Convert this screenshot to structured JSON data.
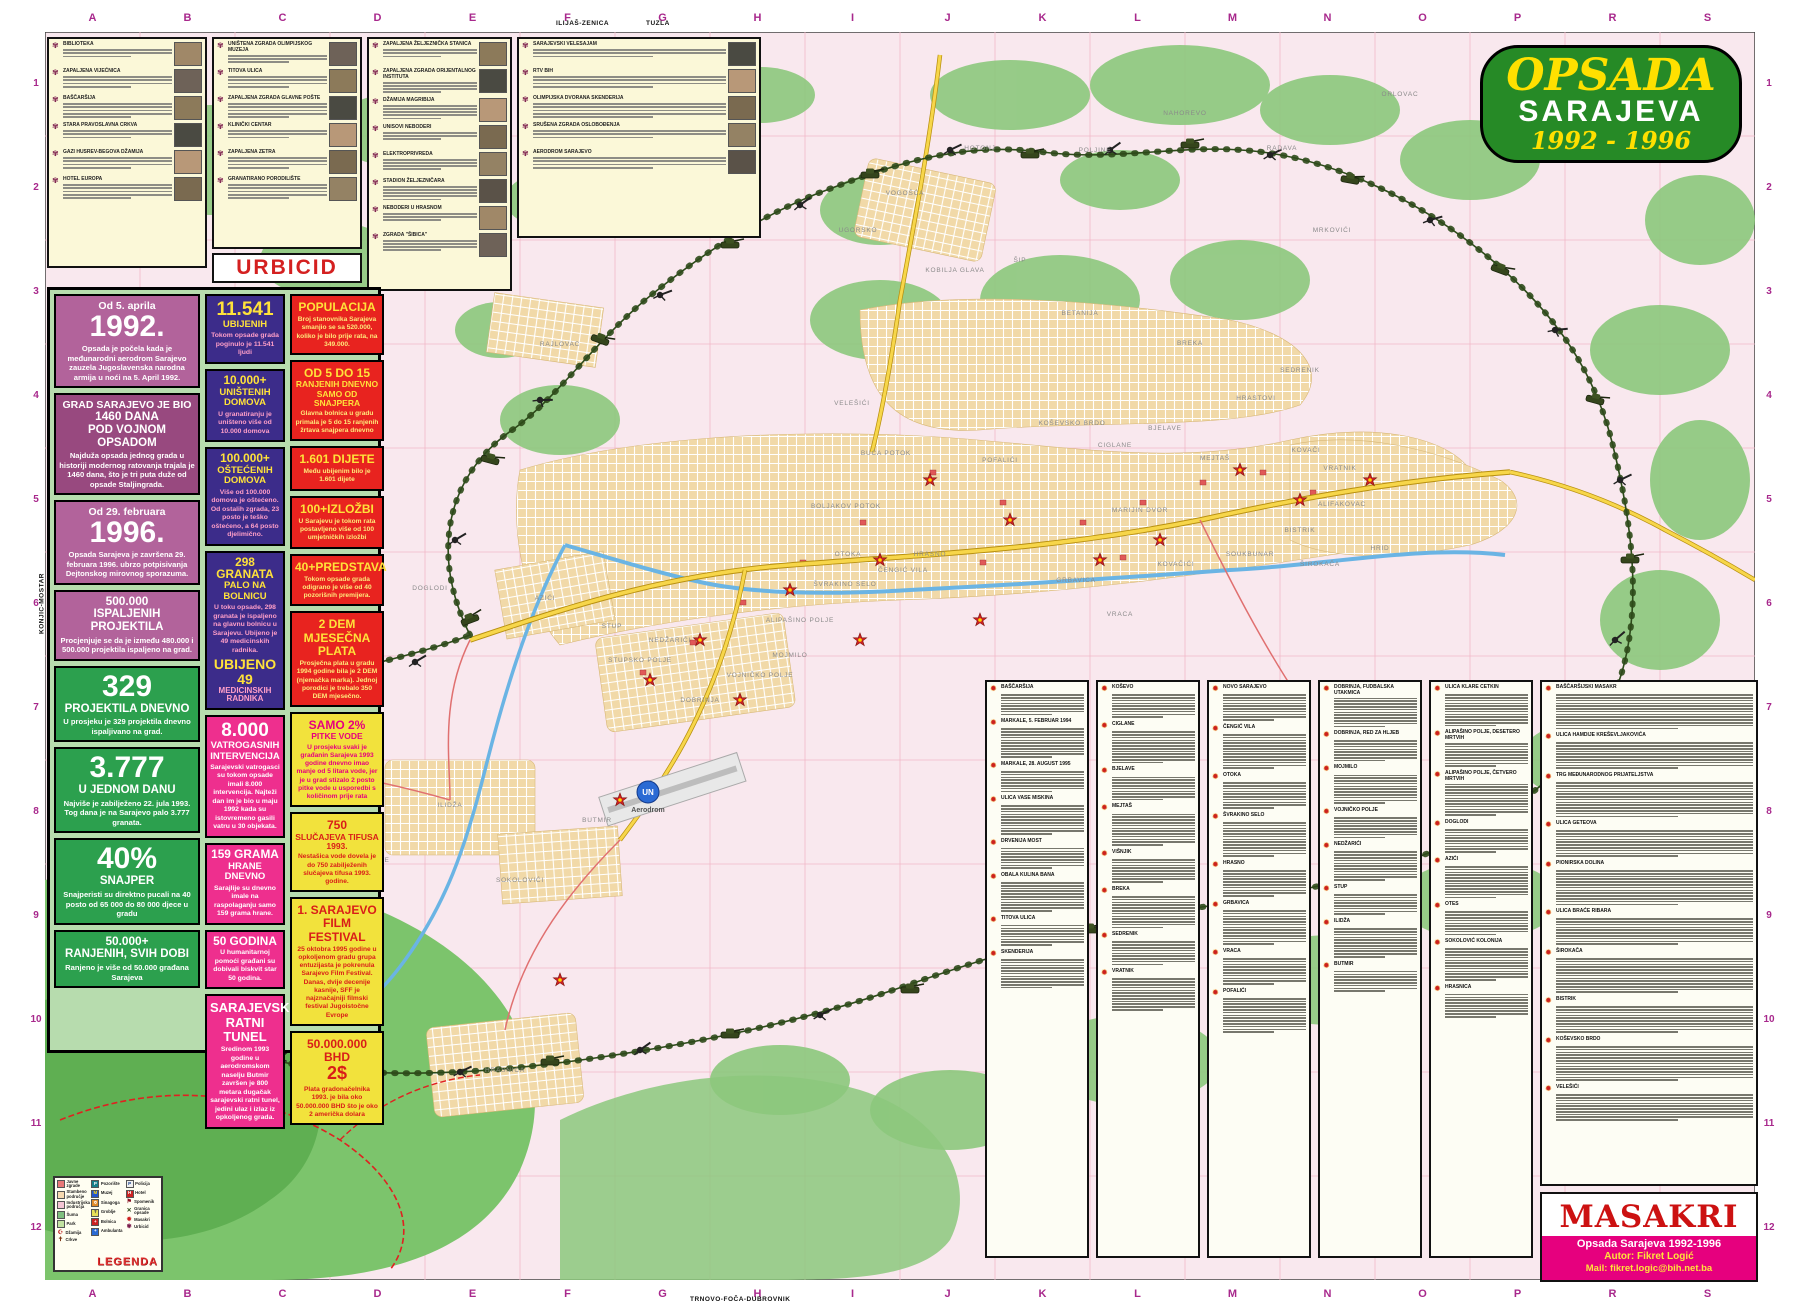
{
  "title": {
    "line1": "OPSADA",
    "line2": "SARAJEVA",
    "line3": "1992 - 1996"
  },
  "edge": {
    "letters": [
      "A",
      "B",
      "C",
      "D",
      "E",
      "F",
      "G",
      "H",
      "I",
      "J",
      "K",
      "L",
      "M",
      "N",
      "O",
      "P",
      "R",
      "S"
    ],
    "numbers": [
      "1",
      "2",
      "3",
      "4",
      "5",
      "6",
      "7",
      "8",
      "9",
      "10",
      "11",
      "12"
    ],
    "top_road_labels": [
      "ILIJAŠ-ZENICA",
      "TUZLA"
    ],
    "bottom_road_label": "TRNOVO-FOČA-DUBROVNIK",
    "left_road_label": "KONJIC-MOSTAR"
  },
  "urbicid": {
    "label": "URBICID",
    "panels": [
      {
        "entries": [
          "BIBLIOTEKA",
          "ZAPALJENA VIJEĆNICA",
          "BAŠČARŠIJA",
          "STARA PRAVOSLAVNA CRKVA",
          "GAZI HUSREV-BEGOVA DŽAMIJA",
          "HOTEL EUROPA"
        ]
      },
      {
        "entries": [
          "UNIŠTENA ZGRADA OLIMPIJSKOG MUZEJA",
          "TITOVA ULICA",
          "ZAPALJENA ZGRADA GLAVNE POŠTE",
          "KLINIČKI CENTAR",
          "ZAPALJENA ZETRA",
          "GRANATIRANO PORODILIŠTE"
        ]
      },
      {
        "entries": [
          "ZAPALJENA ŽELJEZNIČKA STANICA",
          "ZAPALJENA ZGRADA ORIJENTALNOG INSTITUTA",
          "DŽAMIJA MAGRIBIJA",
          "UNISOVI NEBODERI",
          "ELEKTROPRIVREDA",
          "STADION ŽELJEZNIČARA",
          "NEBODERI U HRASNOM",
          "ZGRADA \"ŠIBICA\""
        ]
      },
      {
        "entries": [
          "SARAJEVSKI VELESAJAM",
          "RTV BIH",
          "OLIMPIJSKA DVORANA SKENDERIJA",
          "SRUŠENA ZGRADA OSLOBOĐENJA",
          "AERODROM SARAJEVO"
        ]
      }
    ]
  },
  "stats": {
    "col1": [
      {
        "top": "Od 5. aprila",
        "value": "1992.",
        "body": "Opsada je počela kada je međunarodni aerodrom Sarajevo zauzela Jugoslavenska narodna armija u noći na 5. April 1992.",
        "bg": "#b2639b",
        "fg": "#ffffff",
        "bodyColor": "#ffffff"
      },
      {
        "top": "GRAD SARAJEVO JE BIO",
        "value": "1460 DANA",
        "heading": "POD VOJNOM OPSADOM",
        "body": "Najduža opsada jednog grada u historiji modernog ratovanja trajala je 1460 dana, što je tri puta duže od opsade Staljingrada.",
        "bg": "#98497f",
        "fg": "#ffffff",
        "bodyColor": "#ffffff"
      },
      {
        "top": "Od 29. februara",
        "value": "1996.",
        "body": "Opsada Sarajeva je završena 29. februara 1996. ubrzo potpisivanja Dejtonskog mirovnog sporazuma.",
        "bg": "#b2639b",
        "fg": "#ffffff",
        "bodyColor": "#ffffff"
      },
      {
        "value": "500.000",
        "heading": "ISPALJENIH PROJEKTILA",
        "body": "Procjenjuje se da je između 480.000 i 500.000 projektila ispaljeno na grad.",
        "bg": "#b2639b",
        "fg": "#ffffff",
        "bodyColor": "#ffffff"
      },
      {
        "value": "329",
        "heading": "PROJEKTILA DNEVNO",
        "body": "U prosjeku je 329 projektila dnevno ispaljivano na grad.",
        "bg": "#2ca04e",
        "fg": "#ffffff",
        "bodyColor": "#ffffff"
      },
      {
        "value": "3.777",
        "heading": "U JEDNOM DANU",
        "body": "Najviše je zabilježeno 22. jula 1993. Tog dana je na Sarajevo palo 3.777 granata.",
        "bg": "#2ca04e",
        "fg": "#ffffff",
        "bodyColor": "#ffffff"
      },
      {
        "value": "40%",
        "heading": "SNAJPER",
        "body": "Snajperisti su direktno pucali na 40 posto od 65 000 do 80 000 djece u gradu",
        "bg": "#2ca04e",
        "fg": "#ffffff",
        "bodyColor": "#ffffff"
      },
      {
        "value": "50.000+",
        "heading": "RANJENIH, SVIH DOBI",
        "body": "Ranjeno je više od 50.000 građana Sarajeva",
        "bg": "#2ca04e",
        "fg": "#ffffff",
        "bodyColor": "#ffffff"
      }
    ],
    "col2": [
      {
        "value": "11.541",
        "heading": "UBIJENIH",
        "body": "Tokom opsade grada poginulo je 11.541 ljudi",
        "bg": "#3c2c8a",
        "fg": "#ffe23a",
        "bodyColor": "#ff9fc8"
      },
      {
        "value": "10.000+",
        "heading": "UNIŠTENIH DOMOVA",
        "body": "U granatiranju je uništeno više od 10.000 domova",
        "bg": "#3c2c8a",
        "fg": "#ffe23a",
        "bodyColor": "#ff9fc8"
      },
      {
        "value": "100.000+",
        "heading": "OŠTEĆENIH DOMOVA",
        "body": "Više od 100.000 domova je oštećeno. Od ostalih zgrada, 23 posto je teško oštećeno, a 64 posto djelimično.",
        "bg": "#3c2c8a",
        "fg": "#ffe23a",
        "bodyColor": "#ff9fc8"
      },
      {
        "value": "298 GRANATA",
        "heading": "PALO NA BOLNICU",
        "body": "U toku opsade, 298 granata je ispaljeno na glavnu bolnicu u Sarajevu. Ubijeno je 49 medicinskih radnika.",
        "value2": "UBIJENO 49",
        "heading2": "MEDICINSKIH RADNIKA",
        "bg": "#3c2c8a",
        "fg": "#ffe23a",
        "bodyColor": "#ff9fc8"
      },
      {
        "value": "8.000",
        "heading": "VATROGASNIH INTERVENCIJA",
        "body": "Sarajevski vatrogasci su tokom opsade imali 8.000 intervencija. Najteži dan im je bio u maju 1992 kada su istovremeno gasili vatru u 30 objekata.",
        "bg": "#ee2f8e",
        "fg": "#ffffff",
        "bodyColor": "#ffffff"
      },
      {
        "value": "159 GRAMA",
        "heading": "HRANE DNEVNO",
        "body": "Sarajlije su dnevno imale na raspolaganju samo 159 grama hrane.",
        "bg": "#ee2f8e",
        "fg": "#ffffff",
        "bodyColor": "#ffffff"
      },
      {
        "value": "50 GODINA",
        "body": "U humanitarnoj pomoći građani su dobivali biskvit star 50 godina.",
        "bg": "#ee2f8e",
        "fg": "#ffffff",
        "bodyColor": "#ffffff"
      },
      {
        "heading": "SARAJEVSKI RATNI TUNEL",
        "body": "Sredinom 1993 godine u aerodromskom naselju Butmir završen je 800 metara dugačak sarajevski ratni tunel, jedini ulaz i izlaz iz opkoljenog grada.",
        "bg": "#ee2f8e",
        "fg": "#ffffff",
        "bodyColor": "#ffffff",
        "bigHeading": true
      }
    ],
    "col3": [
      {
        "heading": "POPULACIJA",
        "body": "Broj stanovnika Sarajeva smanjio se sa 520.000, koliko je bilo prije rata, na 349.000.",
        "bg": "#e8231f",
        "fg": "#ffe23a",
        "bodyColor": "#ffe97a"
      },
      {
        "heading": "OD 5 DO 15",
        "sub": "RANJENIH DNEVNO SAMO OD SNAJPERA",
        "body": "Glavna bolnica u gradu primala je 5 do 15 ranjenih žrtava snajpera dnevno",
        "bg": "#e8231f",
        "fg": "#ffe23a",
        "bodyColor": "#ffe97a"
      },
      {
        "heading": "1.601 DIJETE",
        "body": "Među ubijenim bilo je 1.601 dijete",
        "bg": "#e8231f",
        "fg": "#ffe23a",
        "bodyColor": "#ffe97a"
      },
      {
        "heading": "100+IZLOŽBI",
        "body": "U Sarajevu je tokom rata postavljeno više od 100 umjetničkih izložbi",
        "bg": "#e8231f",
        "fg": "#ffe23a",
        "bodyColor": "#ffe97a"
      },
      {
        "heading": "40+PREDSTAVA",
        "body": "Tokom opsade grada odigrano je više od 40 pozorišnih premijera.",
        "bg": "#e8231f",
        "fg": "#ffe23a",
        "bodyColor": "#ffe97a"
      },
      {
        "heading": "2 DEM MJESEČNA PLATA",
        "body": "Prosječna plata u gradu 1994 godine bila je 2 DEM (njemačka marka). Jednoj porodici je trebalo 350 DEM mjesečno.",
        "bg": "#e8231f",
        "fg": "#ffe23a",
        "bodyColor": "#ffe97a"
      },
      {
        "heading": "SAMO 2%",
        "sub": "PITKE VODE",
        "body": "U prosjeku svaki je građanin Sarajeva 1993 godine dnevno imao manje od 5 litara vode, jer je u grad stizalo 2 posto pitke vode u usporedbi s količinom prije rata",
        "bg": "#f2e23c",
        "fg": "#e6007e",
        "bodyColor": "#e6007e"
      },
      {
        "heading": "750",
        "sub": "SLUČAJEVA TIFUSA 1993.",
        "body": "Nestašica vode dovela je do 750 zabilježenih slučajeva tifusa 1993. godine.",
        "bg": "#f2e23c",
        "fg": "#d91e18",
        "bodyColor": "#d91e18"
      },
      {
        "heading": "1. SARAJEVO FILM FESTIVAL",
        "body": "25 oktobra 1995 godine u opkoljenom gradu grupa entuzijasta je pokrenula Sarajevo Film Festival. Danas, dvije decenije kasnije, SFF je najznačajniji filmski festival Jugoistočne Evrope",
        "bg": "#f2e23c",
        "fg": "#d91e18",
        "bodyColor": "#d91e18"
      },
      {
        "heading": "50.000.000 BHD",
        "sub": "2$",
        "body": "Plata gradonačelnika 1993. je bila oko 50.000.000 BHD što je oko 2 američka dolara",
        "bg": "#f2e23c",
        "fg": "#d91e18",
        "bodyColor": "#d91e18",
        "bigSub": true
      }
    ]
  },
  "legend": {
    "title": "LEGENDA",
    "columns": [
      [
        {
          "label": "Javne zgrade",
          "swatch": "#e87878"
        },
        {
          "label": "Stambeno područje",
          "swatch": "#f6d9b0"
        },
        {
          "label": "Industrijska područja",
          "swatch": "#f4c4d4"
        },
        {
          "label": "Šuma",
          "swatch": "#7fbf7f"
        },
        {
          "label": "Park",
          "swatch": "#c2e2a2"
        },
        {
          "label": "Džamija",
          "glyph": "☪",
          "color": "#c02020"
        },
        {
          "label": "Crkve",
          "glyph": "✝",
          "color": "#7a3010"
        }
      ],
      [
        {
          "label": "Pozorište",
          "swatch": "#177f8a",
          "glyph": "P",
          "glyphColor": "#ffffff"
        },
        {
          "label": "Muzej",
          "swatch": "#2255cc",
          "glyph": "M",
          "glyphColor": "#ffd700"
        },
        {
          "label": "Sinagoga",
          "swatch": "#e08a2a",
          "glyph": "✡",
          "glyphColor": "#ffffff"
        },
        {
          "label": "Groblje",
          "swatch": "#e8e057",
          "glyph": "✝",
          "glyphColor": "#555555"
        },
        {
          "label": "Bolnica",
          "swatch": "#cc2222",
          "glyph": "+",
          "glyphColor": "#ffffff"
        },
        {
          "label": "Ambulanta",
          "swatch": "#2a6ad4",
          "glyph": "+",
          "glyphColor": "#ffffff"
        }
      ],
      [
        {
          "label": "Policija",
          "swatch": "#f0f0f0",
          "glyph": "P",
          "glyphColor": "#123a8a"
        },
        {
          "label": "Hotel",
          "swatch": "#cc2222",
          "glyph": "H",
          "glyphColor": "#ffffff"
        },
        {
          "label": "Spomenik",
          "glyph": "⚑",
          "color": "#8a1020"
        },
        {
          "label": "Granica opsade",
          "glyph": "✕",
          "color": "#2d4a1a"
        },
        {
          "label": "Masakri",
          "glyph": "✹",
          "color": "#cc2020"
        },
        {
          "label": "Urbicid",
          "glyph": "✾",
          "color": "#7a1a4a"
        }
      ]
    ]
  },
  "masakri": {
    "title": "MASAKRI",
    "credit_line1": "Opsada Sarajeva 1992-1996",
    "credit_line2": "Autor: Fikret Logić",
    "credit_line3": "Mail: fikret.logic@bih.net.ba",
    "columns": [
      {
        "entries": [
          "BAŠČARŠIJA",
          "MARKALE, 5. FEBRUAR 1994",
          "MARKALE, 28. AUGUST 1995",
          "ULICA VASE MISKINA",
          "DRVENIJA MOST",
          "OBALA KULINA BANA",
          "TITOVA ULICA",
          "SKENDERIJA"
        ]
      },
      {
        "entries": [
          "KOŠEVO",
          "CIGLANE",
          "BJELAVE",
          "MEJTAŠ",
          "VIŠNJIK",
          "BREKA",
          "SEDRENIK",
          "VRATNIK"
        ]
      },
      {
        "entries": [
          "NOVO SARAJEVO",
          "ČENGIĆ VILA",
          "OTOKA",
          "ŠVRAKINO SELO",
          "HRASNO",
          "GRBAVICA",
          "VRACA",
          "POFALIĆI"
        ]
      },
      {
        "entries": [
          "DOBRINJA, FUDBALSKA UTAKMICA",
          "DOBRINJA, RED ZA HLJEB",
          "MOJMILO",
          "VOJNIČKO POLJE",
          "NEDŽARIĆI",
          "STUP",
          "ILIDŽA",
          "BUTMIR"
        ]
      },
      {
        "entries": [
          "ULICA KLARE CETKIN",
          "ALIPAŠINO POLJE, DESETERO MRTVIH",
          "ALIPAŠINO POLJE, ČETVERO MRTVIH",
          "DOGLODI",
          "AZIĆI",
          "OTES",
          "SOKOLOVIĆ KOLONIJA",
          "HRASNICA"
        ]
      },
      {
        "entries": [
          "BAŠČARŠIJSKI MASAKR",
          "ULICA HAMDIJE KREŠEVLJAKOVIĆA",
          "TRG MEĐUNARODNOG PRIJATELJSTVA",
          "ULICA GETEOVA",
          "PIONIRSKA DOLINA",
          "ULICA BRAĆE RIBARA",
          "ŠIROKAČA",
          "BISTRIK",
          "KOŠEVSKO BRDO",
          "VELEŠIĆI"
        ]
      }
    ]
  },
  "map": {
    "un_label": "UN",
    "airport_label": "Aerodrom",
    "igman_label": "I g m a n",
    "labels": [
      {
        "t": "VOGOŠĆA",
        "x": 905,
        "y": 195
      },
      {
        "t": "HOTONJ",
        "x": 980,
        "y": 150
      },
      {
        "t": "UGORSKO",
        "x": 858,
        "y": 232
      },
      {
        "t": "KOBILJA GLAVA",
        "x": 955,
        "y": 272
      },
      {
        "t": "BETANIJA",
        "x": 1080,
        "y": 315
      },
      {
        "t": "ŠIP",
        "x": 1020,
        "y": 262
      },
      {
        "t": "POLJINE",
        "x": 1095,
        "y": 152
      },
      {
        "t": "NAHOREVO",
        "x": 1185,
        "y": 115
      },
      {
        "t": "RADAVA",
        "x": 1282,
        "y": 150
      },
      {
        "t": "MRKOVIĆI",
        "x": 1332,
        "y": 232
      },
      {
        "t": "SEDRENIK",
        "x": 1300,
        "y": 372
      },
      {
        "t": "HRASTOVI",
        "x": 1256,
        "y": 400
      },
      {
        "t": "KOŠEVSKO BRDO",
        "x": 1072,
        "y": 425
      },
      {
        "t": "BREKA",
        "x": 1190,
        "y": 345
      },
      {
        "t": "BJELAVE",
        "x": 1165,
        "y": 430
      },
      {
        "t": "CIGLANE",
        "x": 1115,
        "y": 447
      },
      {
        "t": "VELEŠIĆI",
        "x": 852,
        "y": 405
      },
      {
        "t": "POFALIĆI",
        "x": 1000,
        "y": 462
      },
      {
        "t": "BUĆA POTOK",
        "x": 886,
        "y": 455
      },
      {
        "t": "BOLJAKOV POTOK",
        "x": 846,
        "y": 508
      },
      {
        "t": "HRASNO",
        "x": 930,
        "y": 556
      },
      {
        "t": "ČENGIĆ VILA",
        "x": 903,
        "y": 572
      },
      {
        "t": "OTOKA",
        "x": 848,
        "y": 556
      },
      {
        "t": "GRBAVICA",
        "x": 1076,
        "y": 582
      },
      {
        "t": "KOVAČIĆI",
        "x": 1176,
        "y": 566
      },
      {
        "t": "VRACA",
        "x": 1120,
        "y": 616
      },
      {
        "t": "MOJMILO",
        "x": 790,
        "y": 657
      },
      {
        "t": "ALIPAŠINO POLJE",
        "x": 800,
        "y": 622
      },
      {
        "t": "VOJNIČKO POLJE",
        "x": 760,
        "y": 677
      },
      {
        "t": "DOBRINJA",
        "x": 700,
        "y": 702
      },
      {
        "t": "NEDŽARIĆI",
        "x": 670,
        "y": 642
      },
      {
        "t": "STUP",
        "x": 612,
        "y": 628
      },
      {
        "t": "STUPSKO POLJE",
        "x": 640,
        "y": 662
      },
      {
        "t": "AZIĆI",
        "x": 545,
        "y": 600
      },
      {
        "t": "ILIDŽA",
        "x": 450,
        "y": 807
      },
      {
        "t": "BUTMIR",
        "x": 597,
        "y": 822
      },
      {
        "t": "SOKOLOVIĆI",
        "x": 520,
        "y": 882
      },
      {
        "t": "HRASNICA",
        "x": 505,
        "y": 1072
      },
      {
        "t": "VRELO BOSNE",
        "x": 362,
        "y": 862
      },
      {
        "t": "BLAŽUJ",
        "x": 300,
        "y": 772
      },
      {
        "t": "LUKAVICA",
        "x": 1040,
        "y": 872
      },
      {
        "t": "VRATNIK",
        "x": 1340,
        "y": 470
      },
      {
        "t": "KOVAČI",
        "x": 1306,
        "y": 452
      },
      {
        "t": "BISTRIK",
        "x": 1300,
        "y": 532
      },
      {
        "t": "ALIFAKOVAC",
        "x": 1342,
        "y": 506
      },
      {
        "t": "ŠIROKAČA",
        "x": 1320,
        "y": 566
      },
      {
        "t": "SOUKBUNAR",
        "x": 1250,
        "y": 556
      },
      {
        "t": "HRID",
        "x": 1380,
        "y": 550
      },
      {
        "t": "MEJTAŠ",
        "x": 1215,
        "y": 460
      },
      {
        "t": "MARIJIN DVOR",
        "x": 1140,
        "y": 512
      },
      {
        "t": "ORLOVAC",
        "x": 1400,
        "y": 96
      },
      {
        "t": "RAJLOVAC",
        "x": 560,
        "y": 346
      },
      {
        "t": "RELJEVO",
        "x": 430,
        "y": 290
      },
      {
        "t": "DOGLODI",
        "x": 430,
        "y": 590
      },
      {
        "t": "ŠVRAKINO SELO",
        "x": 845,
        "y": 586
      }
    ]
  }
}
